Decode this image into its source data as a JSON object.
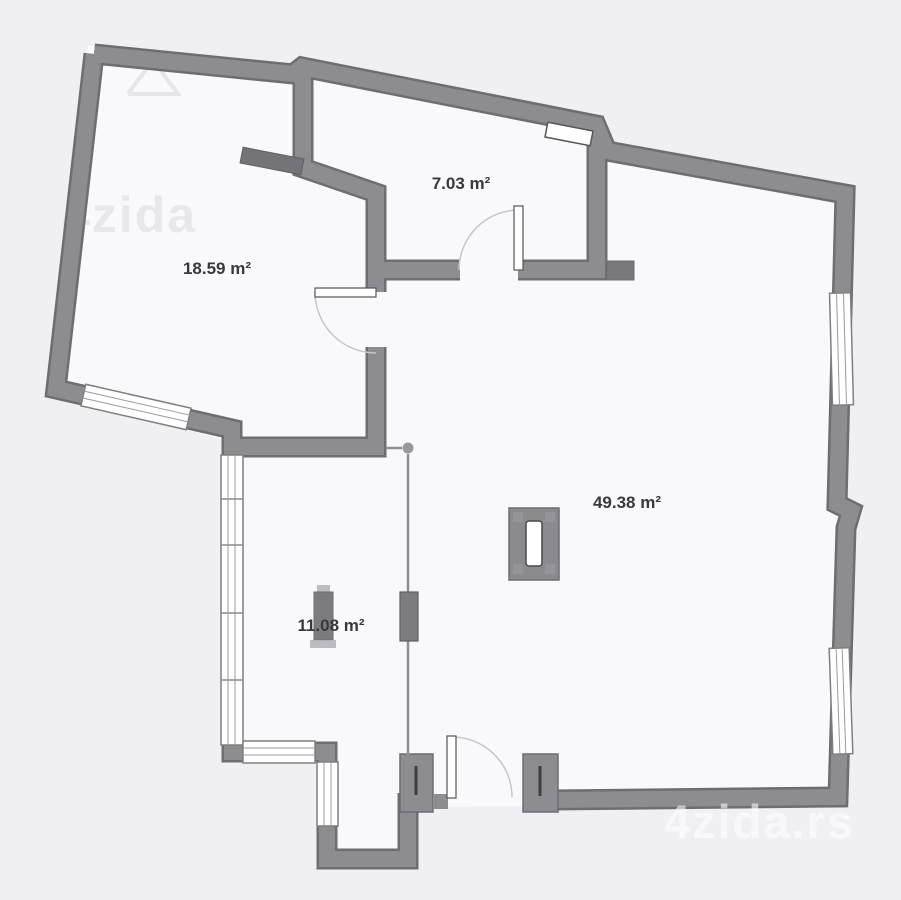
{
  "plan": {
    "type": "floor-plan",
    "rooms": [
      {
        "id": "room-living-left",
        "area_label": "18.59 m²"
      },
      {
        "id": "room-top-small",
        "area_label": "7.03 m²"
      },
      {
        "id": "room-main-large",
        "area_label": "49.38 m²"
      },
      {
        "id": "room-terrace",
        "area_label": "11.08 m²"
      }
    ],
    "watermark_top": "4zida",
    "watermark_bottom": "4zida.rs",
    "colors": {
      "background": "#f0f0f4",
      "floor": "#f9f9fb",
      "wall_fill": "#8c8c91",
      "wall_edge": "#6d6d72",
      "dark_stub": "#737378",
      "label_text": "#39393c",
      "door_arc": "#c6c6cb",
      "window_line": "#9a9a9f"
    }
  }
}
